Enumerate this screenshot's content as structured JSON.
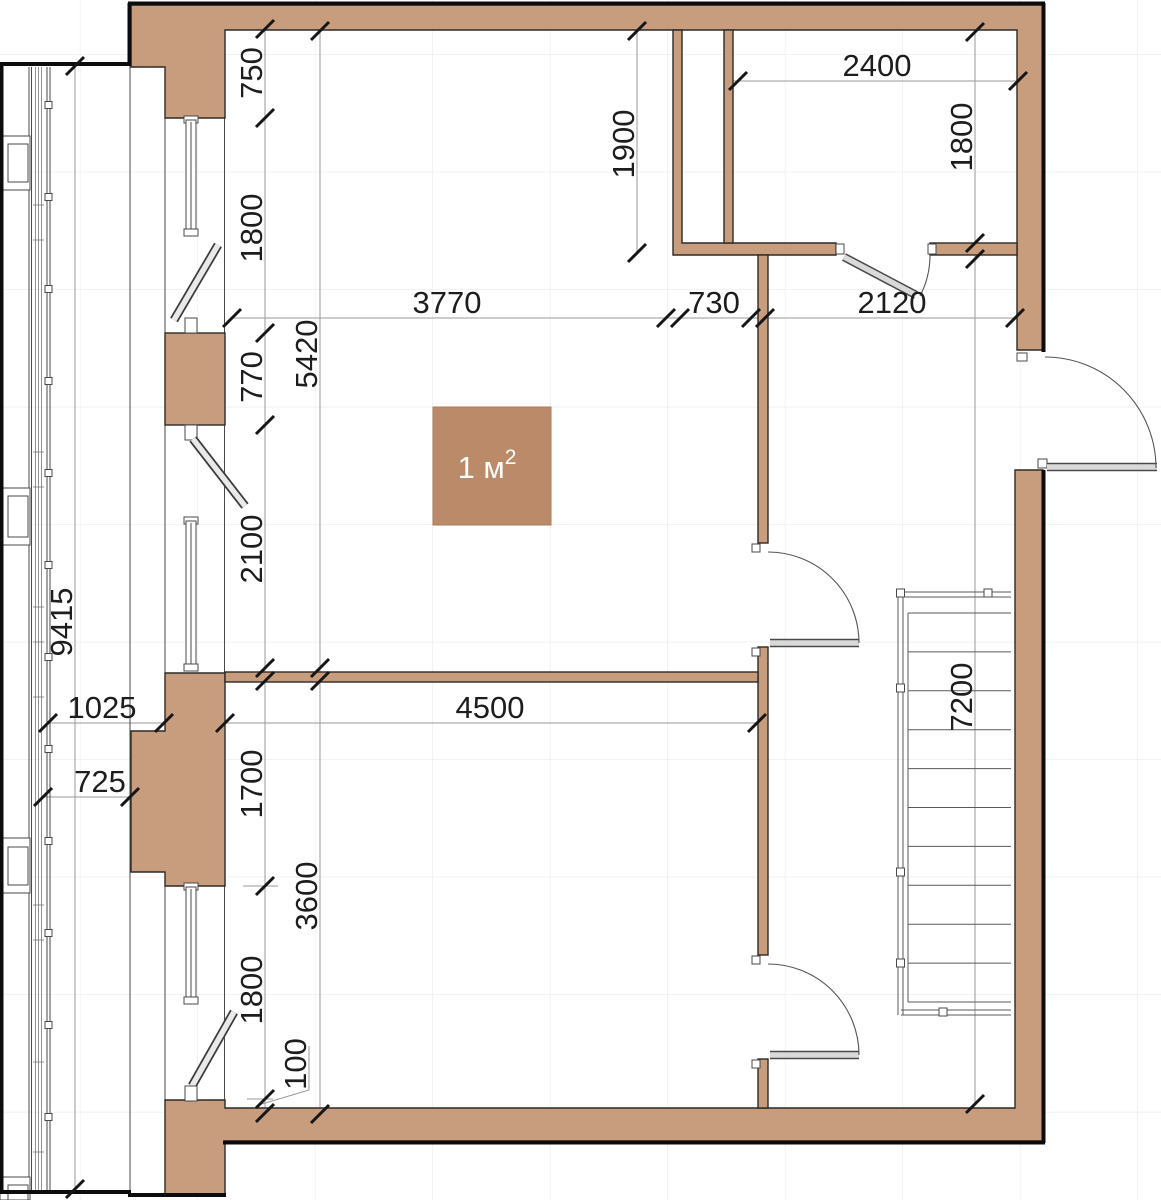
{
  "drawing": {
    "type": "apartment-floor-plan",
    "units": "mm"
  },
  "area_square": {
    "main": "1 м",
    "sup": "2"
  },
  "dims": {
    "d750": "750",
    "d1800_left_upper": "1800",
    "d770": "770",
    "d2100": "2100",
    "d5420": "5420",
    "d1700": "1700",
    "d1800_left_lower": "1800",
    "d3600": "3600",
    "d100": "100",
    "d9415": "9415",
    "d1025": "1025",
    "d725": "725",
    "d4500": "4500",
    "d3770": "3770",
    "d730": "730",
    "d2120": "2120",
    "d1900": "1900",
    "d2400": "2400",
    "d1800_top_right": "1800",
    "d7200": "7200"
  },
  "colors": {
    "wall": "#c89d7e",
    "area_square": "#bb8a69",
    "dim_text": "#1d1d1d",
    "outline": "#2d2a26"
  }
}
